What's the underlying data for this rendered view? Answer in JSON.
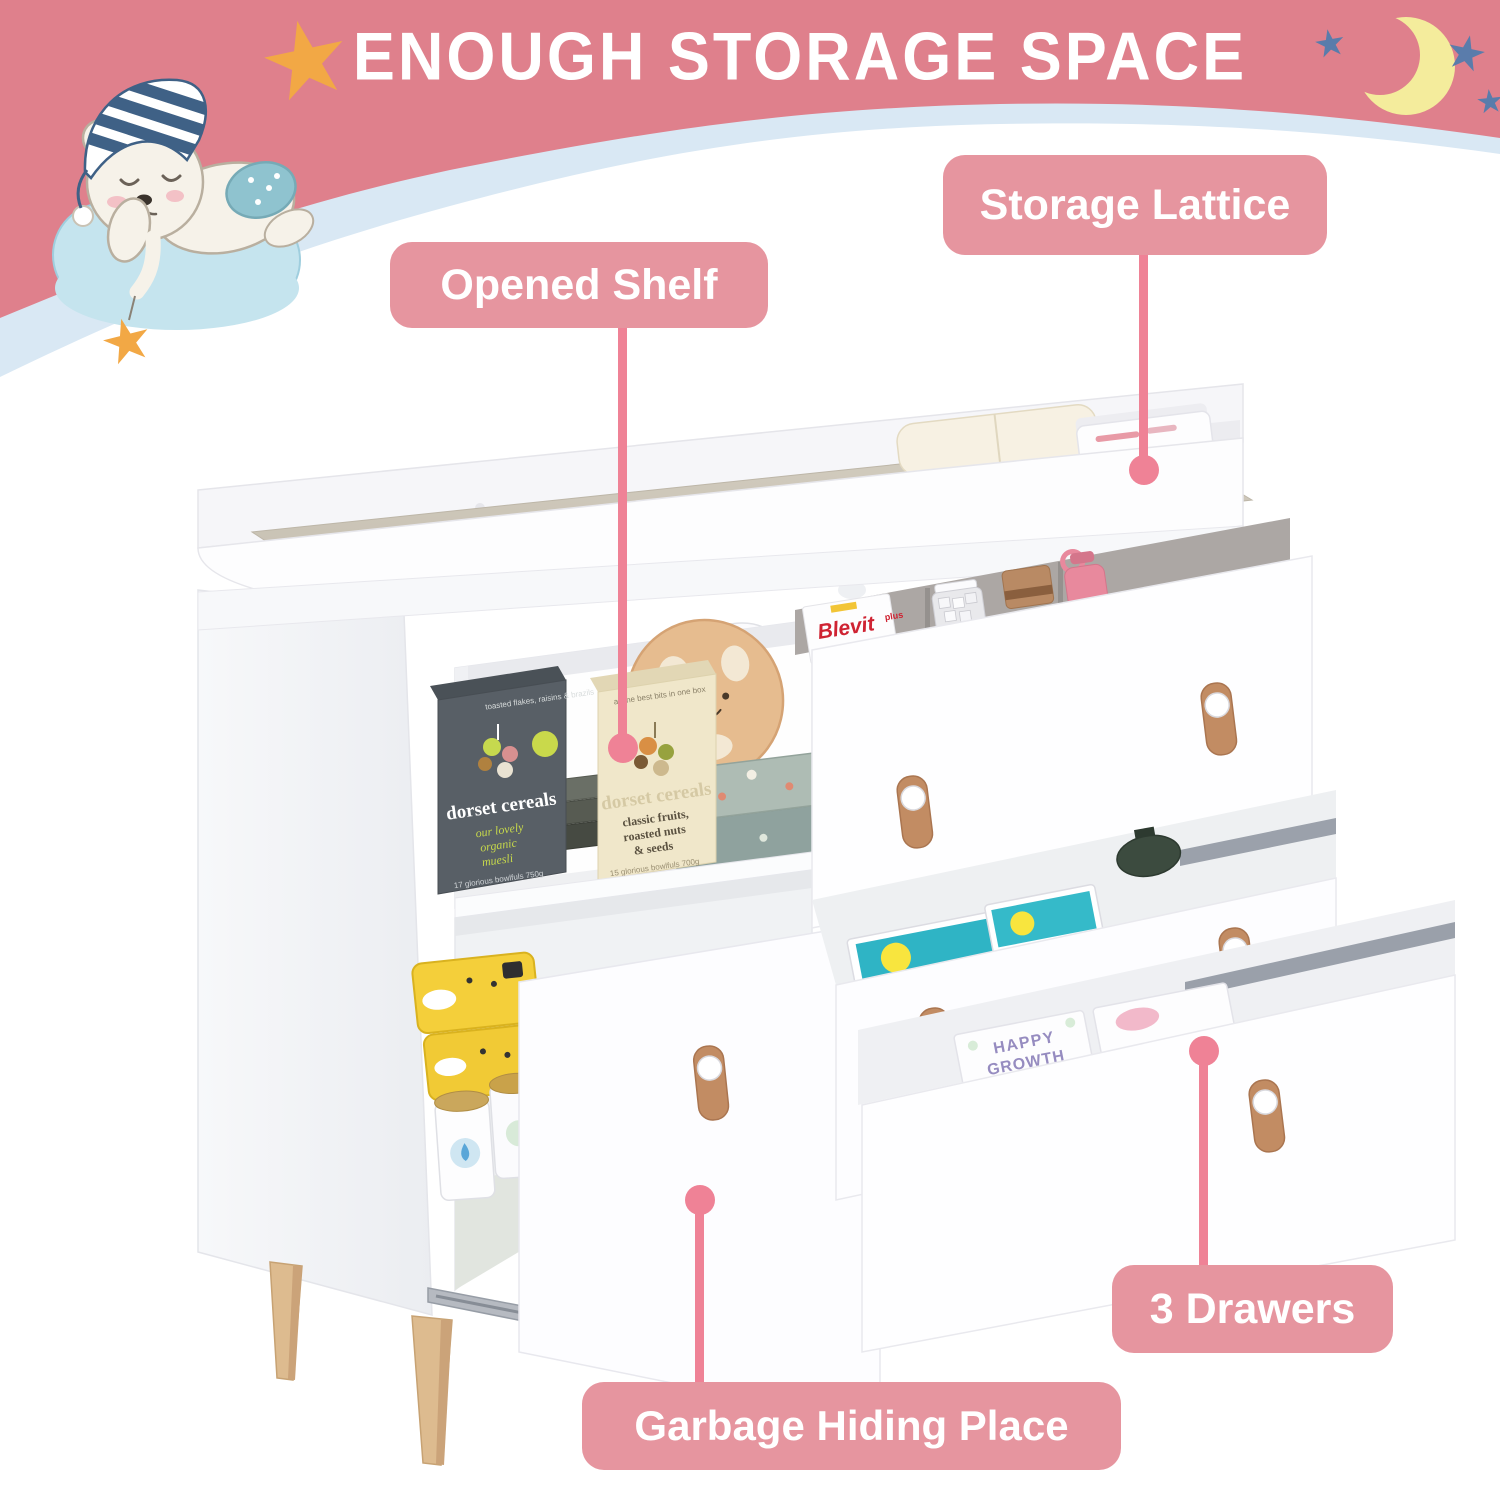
{
  "banner": {
    "title": "ENOUGH STORAGE SPACE",
    "bg_color": "#df808c",
    "stripe_color": "#d9e8f4"
  },
  "callouts": {
    "label_bg": "#e6959f",
    "line_color": "#ef8296",
    "storage_lattice": "Storage Lattice",
    "opened_shelf": "Opened Shelf",
    "three_drawers": "3 Drawers",
    "garbage_hiding_place": "Garbage Hiding Place"
  },
  "products": {
    "cereal_dark": {
      "brand": "dorset cereals",
      "tagline": "toasted flakes, raisins & brazils",
      "desc1": "our lovely",
      "desc2": "organic",
      "desc3": "muesli",
      "footer": "17 glorious bowlfuls 750g"
    },
    "cereal_cream": {
      "brand": "dorset cereals",
      "tagline": "all the best bits in one box",
      "desc1": "classic fruits,",
      "desc2": "roasted nuts",
      "desc3": "& seeds",
      "footer": "15 glorious bowlfuls 700g"
    },
    "blevit": {
      "brand": "Blevit",
      "variant": "plus",
      "subtitle": "8 Cereales"
    },
    "diaper_box": {
      "line1": "HAPPY",
      "line2": "GROWTH"
    },
    "light_box": {
      "label": "LIGHT"
    }
  },
  "colors": {
    "pad": "#cbc4b6",
    "wood_leg": "#ddbb8f",
    "leather_pull": "#c28c63",
    "moon": "#f4ec9c",
    "star_orange": "#f2a845",
    "star_blue": "#5a7cab",
    "cloud": "#c5e4ee"
  }
}
